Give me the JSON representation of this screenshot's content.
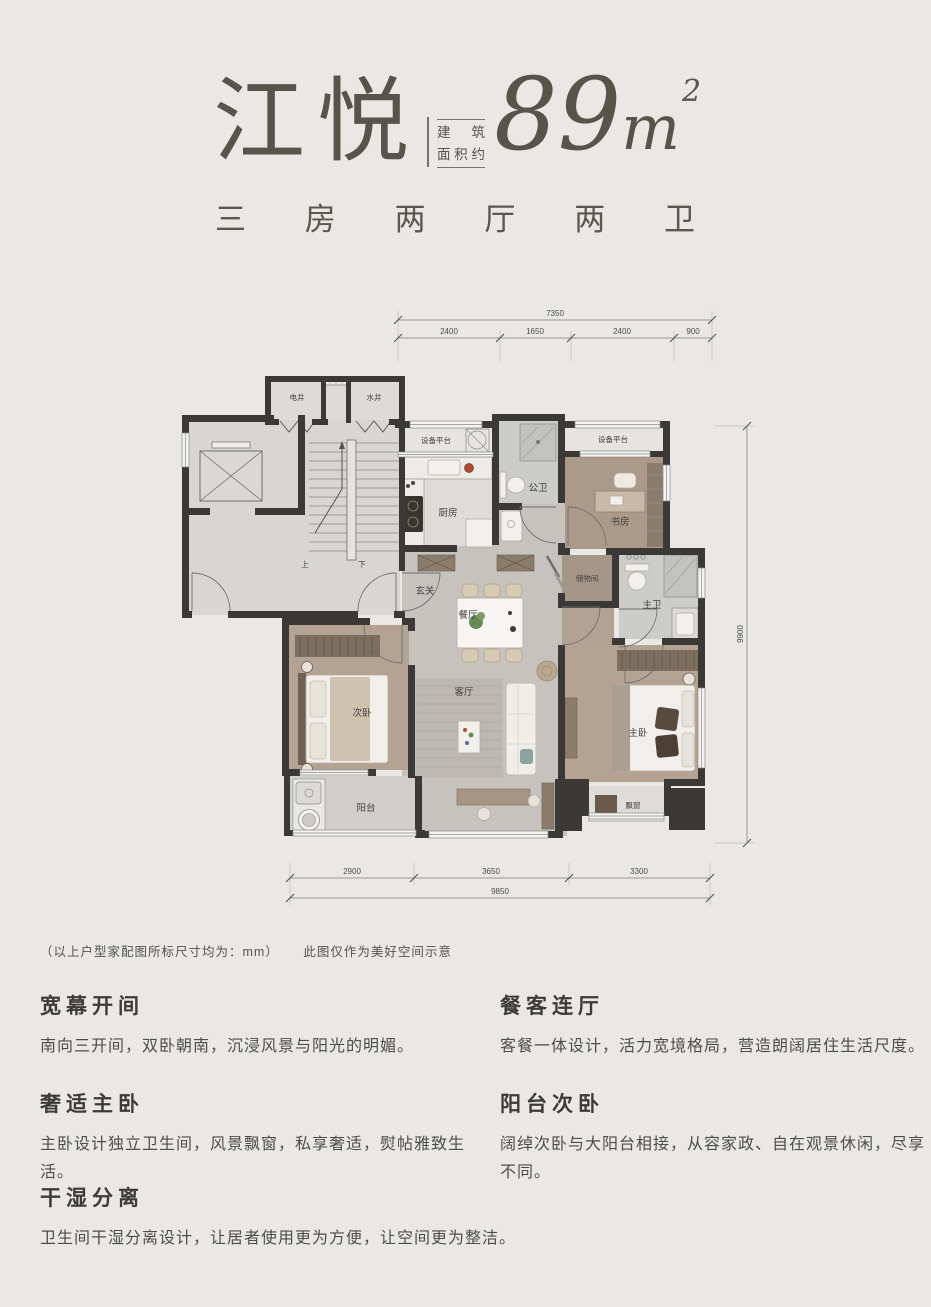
{
  "header": {
    "title": "江悦",
    "area_label_line1": "建筑",
    "area_label_line2": "面积约",
    "area_number": "89",
    "area_unit": "m",
    "area_exponent": "2",
    "type_chars": [
      "三",
      "房",
      "两",
      "厅",
      "两",
      "卫"
    ]
  },
  "plan": {
    "dimensions": {
      "top_total": "7350",
      "top_segments": [
        "2400",
        "1650",
        "2400",
        "900"
      ],
      "bottom_segments": [
        "2900",
        "3650",
        "3300"
      ],
      "bottom_total": "9850",
      "right_total": "9900"
    },
    "rooms": {
      "elec_shaft": "电井",
      "water_shaft": "水井",
      "equip_platform_left": "设备平台",
      "equip_platform_right": "设备平台",
      "kitchen": "厨房",
      "public_bath": "公卫",
      "study": "书房",
      "storage": "储物间",
      "master_bath": "主卫",
      "foyer": "玄关",
      "dining": "餐厅",
      "living": "客厅",
      "second_bedroom": "次卧",
      "master_bedroom": "主卧",
      "balcony": "阳台",
      "bay_window": "飘窗",
      "stairs_up": "上",
      "stairs_down": "下"
    }
  },
  "footnote": {
    "note1": "（以上户型家配图所标尺寸均为：mm）",
    "note2": "此图仅作为美好空间示意"
  },
  "features": [
    {
      "title": "宽幕开间",
      "body": "南向三开间，双卧朝南，沉浸风景与阳光的明媚。"
    },
    {
      "title": "餐客连厅",
      "body": "客餐一体设计，活力宽境格局，营造朗阔居住生活尺度。"
    },
    {
      "title": "奢适主卧",
      "body": "主卧设计独立卫生间，风景飘窗，私享奢适，熨帖雅致生活。"
    },
    {
      "title": "阳台次卧",
      "body": "阔绰次卧与大阳台相接，从容家政、自在观景休闲，尽享不同。"
    },
    {
      "title": "干湿分离",
      "body": "卫生间干湿分离设计，让居者使用更为方便，让空间更为整洁。"
    }
  ],
  "colors": {
    "background": "#e9e8e5",
    "wall": "#3a3937",
    "wood_floor": "#b4a392",
    "marble_floor": "#c6c3bf",
    "lobby_floor": "#d7d6d3",
    "title_text": "#57544c"
  }
}
